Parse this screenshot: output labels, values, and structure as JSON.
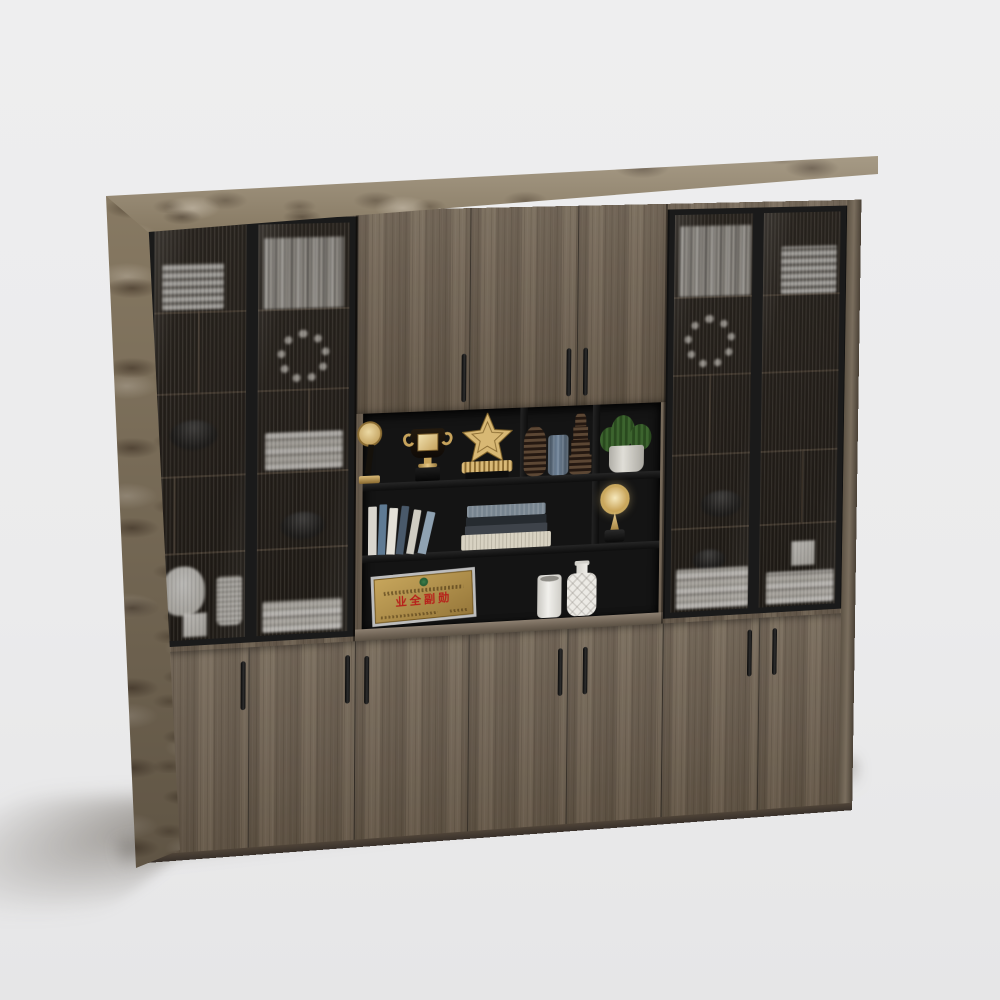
{
  "scene": {
    "type": "3d furniture product render",
    "description": "Large office wood bookcase wall unit with fluted-glass display cabinets, open black shelving with awards and decor, and lower storage doors, on a light grey studio background",
    "background_color": "#ececec"
  },
  "cabinet": {
    "title": "Office bookcase cabinet with glass doors",
    "colors": {
      "wood": "#746858",
      "stone_trim": "#96886f",
      "glass_frame": "#1a1a1a",
      "interior": "#141414",
      "gold_accent": "#c9a85e",
      "handle": "#161616",
      "plaque_red_text": "#b7201a"
    },
    "left_glass_cabinet": {
      "door_count": 2,
      "items": [
        {
          "title": "stack of white document trays"
        },
        {
          "title": "row of books"
        },
        {
          "title": "round wreath ornament"
        },
        {
          "title": "dark bowl"
        },
        {
          "title": "stack of white books"
        },
        {
          "title": "dark bowl"
        },
        {
          "title": "white table lamp"
        },
        {
          "title": "ribbed cup"
        },
        {
          "title": "small white box"
        }
      ]
    },
    "center_section": {
      "upper_door_count": 3,
      "lower_door_count": 3,
      "open_shelf_items": [
        {
          "title": "gold medal trophy"
        },
        {
          "title": "gold trophy cup"
        },
        {
          "title": "gold star award"
        },
        {
          "title": "bronze ribbed vase"
        },
        {
          "title": "blue glass vase"
        },
        {
          "title": "bronze tiered vase"
        },
        {
          "title": "succulent in grey pot"
        },
        {
          "title": "leaning books"
        },
        {
          "title": "stack of books"
        },
        {
          "title": "gold round award"
        },
        {
          "title": "white cylinder vase"
        },
        {
          "title": "white patterned bottle vase"
        }
      ],
      "award_plaque": {
        "main_text": "业全副勋",
        "style": "gold plaque with silver frame, green emblem and red characters"
      }
    },
    "right_glass_cabinet": {
      "door_count": 2,
      "items": [
        {
          "title": "row of books"
        },
        {
          "title": "stack of white document trays"
        },
        {
          "title": "round wreath ornament"
        },
        {
          "title": "dark bowl"
        },
        {
          "title": "stack of white books with bowl"
        },
        {
          "title": "stack of white books"
        },
        {
          "title": "small white box"
        }
      ]
    },
    "bottom_row": {
      "door_count": 7,
      "handle_style": "black vertical bar handles"
    }
  }
}
